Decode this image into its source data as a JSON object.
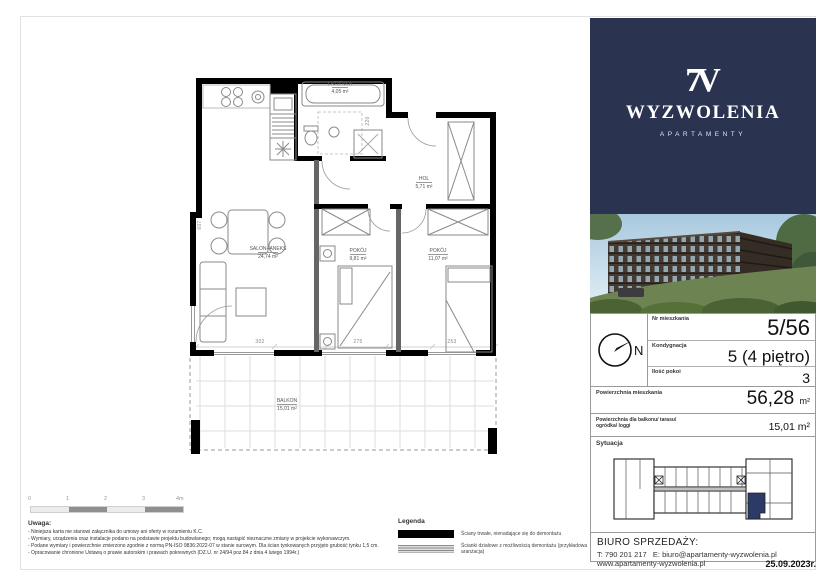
{
  "brand": {
    "mark": "7V",
    "name": "WYZWOLENIA",
    "tagline": "APARTAMENTY"
  },
  "unit_card": {
    "north": "N",
    "rows": [
      {
        "label": "Nr mieszkania",
        "value": "5/56"
      },
      {
        "label": "Kondygnacja",
        "value": "5 (4 piętro)"
      },
      {
        "label": "Ilość pokoi",
        "value": "3"
      },
      {
        "label": "Powierzchnia mieszkania",
        "value": "56,28",
        "unit": "m²"
      },
      {
        "label": "Powierzchnia dla balkonu/ tarasu/ ogródka/ loggi",
        "value": "15,01 m²"
      }
    ],
    "situation_title": "Sytuacja"
  },
  "contact": {
    "heading": "BIURO SPRZEDAŻY:",
    "phone": "T: 790 201 217",
    "email": "E: biuro@apartamenty-wyzwolenia.pl",
    "website": "www.apartamenty-wyzwolenia.pl"
  },
  "issue_date": "25.09.2023r.",
  "plan": {
    "rooms": [
      {
        "name": "ŁAZIENKA",
        "area": "4,05 m²"
      },
      {
        "name": "HOL",
        "area": "5,71 m²"
      },
      {
        "name": "SALON+ANEKS",
        "area": "24,74 m²"
      },
      {
        "name": "POKÓJ",
        "area": "9,81 m²"
      },
      {
        "name": "POKÓJ",
        "area": "11,07 m²"
      },
      {
        "name": "BALKON",
        "area": "15,01 m²"
      }
    ],
    "dims": {
      "d1": "302",
      "d2": "275",
      "d3": "253",
      "left": "607",
      "hall": "220"
    },
    "scale": [
      "0",
      "1",
      "2",
      "3",
      "4m"
    ]
  },
  "legend": {
    "title": "Legenda",
    "solid": "Ściany trwałe, nienadające się do demontażu",
    "partition": "Ścianki działowe z możliwością demontażu (przykładowa aranżacja)"
  },
  "notes": {
    "title": "Uwaga:",
    "items": [
      "- Niniejsza karta nie stanowi załącznika do umowy ani oferty w rozumieniu K.C.",
      "- Wymiary, urządzenia oraz instalacje podano na podstawie projektu budowlanego; mogą nastąpić nieznaczne zmiany w projekcie wykonawczym.",
      "- Podane wymiary i powierzchnie zmierzono zgodnie z normą PN-ISO 9836:2022-07 w stanie surowym. Dla ścian tynkowanych przyjęto grubość tynku 1,5 cm.",
      "- Opracowanie chronione Ustawą o prawie autorskim i prawach pokrewnych (DZ.U. nr 24/94 poz.84 z dnia 4 lutego 1994r.)"
    ]
  },
  "colors": {
    "navy": "#2a3451",
    "wall": "#000000",
    "partition": "#666666"
  }
}
